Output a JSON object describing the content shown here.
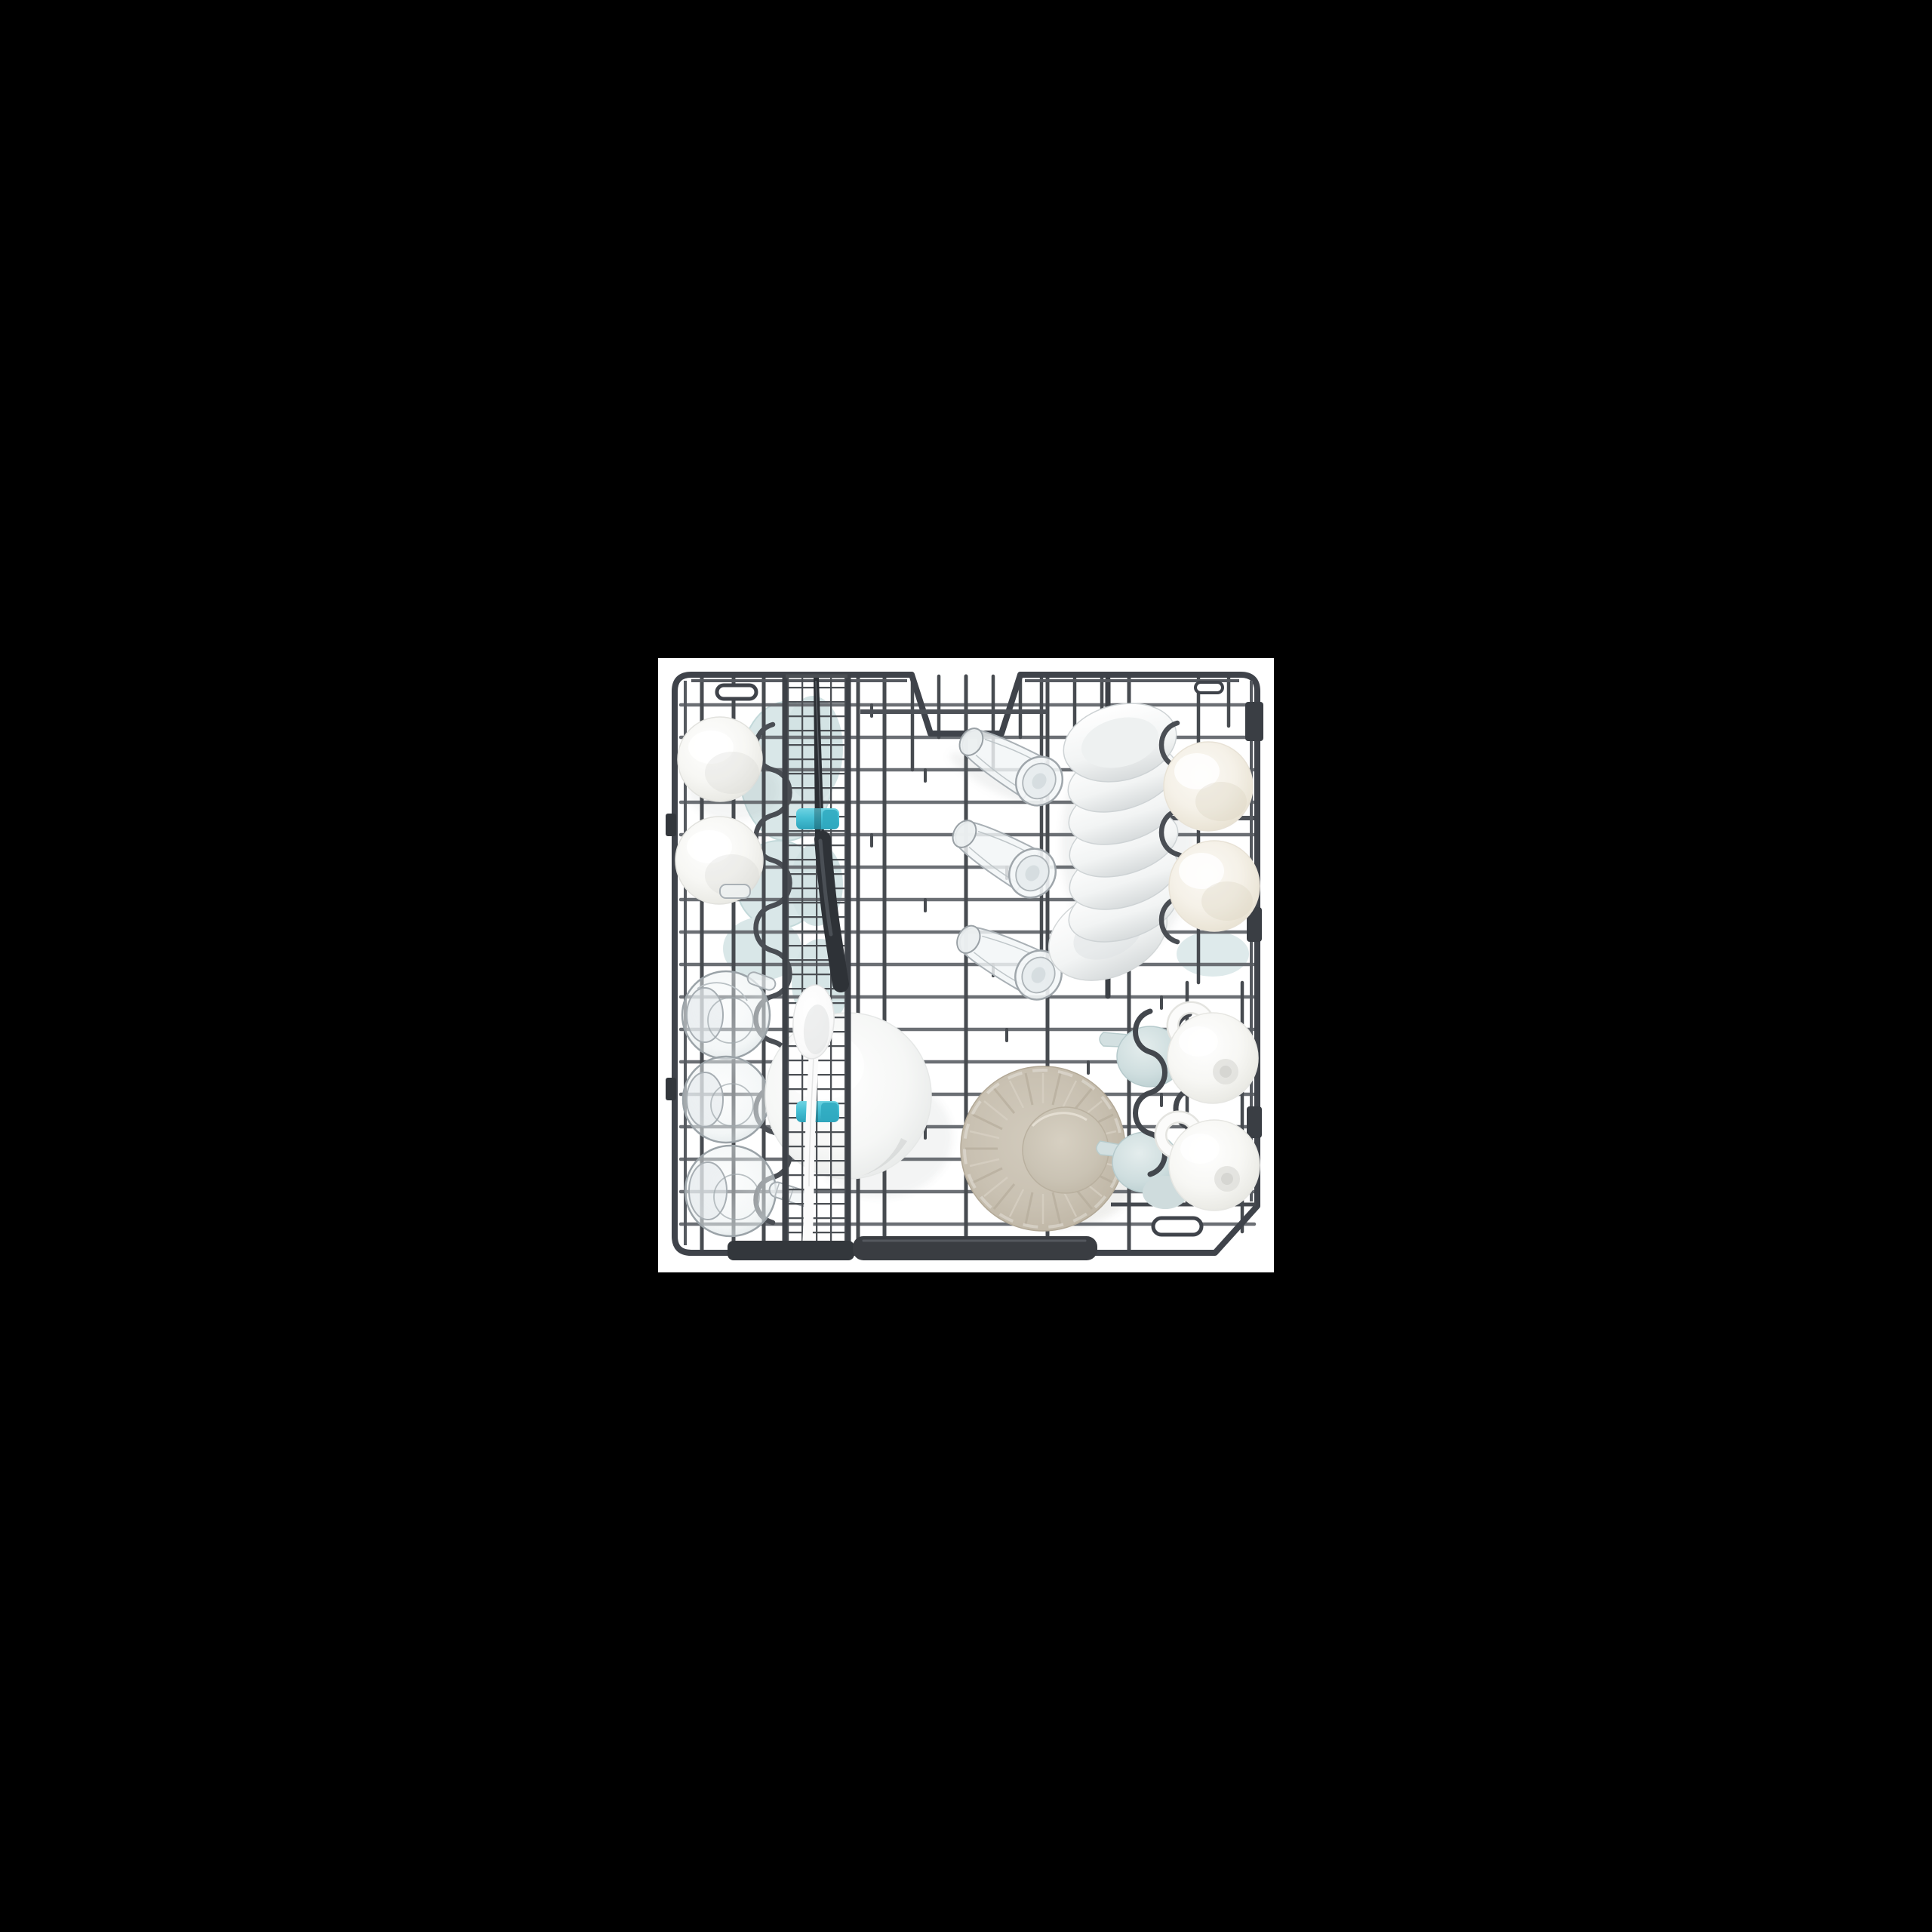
{
  "page": {
    "background": "#000000"
  },
  "photo": {
    "description": "Top-down product photograph of an open dishwasher lower rack loaded with dishes on a white background",
    "background": "#ffffff"
  },
  "colors": {
    "canvas_black": "#000000",
    "photo_white": "#ffffff",
    "rack_frame": "#3f434a",
    "rack_wire_light": "#6b6f74",
    "rack_wire_dark": "#474b50",
    "rack_bar_dark": "#34383d",
    "clip_teal": "#45bfd4",
    "dish_white": "#f8f9f8",
    "dish_cream": "#f4f0e7",
    "tinted_glass_blue": "#d9e7e8",
    "plate_beige": "#c9c1b1",
    "glass_outline": "#a0a7ac",
    "knife_black": "#2e3237"
  },
  "items": [
    {
      "id": "rack-frame",
      "label": "Dishwasher lower rack wire frame with top notch"
    },
    {
      "id": "wire-grid",
      "label": "Dark gray wire grid of the rack"
    },
    {
      "id": "cutlery-strip",
      "label": "Fine-mesh cutlery rack strip"
    },
    {
      "id": "knife",
      "label": "Black-handled knife in cutlery strip"
    },
    {
      "id": "spoon",
      "label": "White serving spoon in cutlery strip"
    },
    {
      "id": "teal-clips",
      "label": "Turquoise retaining clips"
    },
    {
      "id": "left-bowls",
      "label": "Two white bowls upside down"
    },
    {
      "id": "tinted-plates",
      "label": "Pale blue tinted glass plates"
    },
    {
      "id": "glass-jars",
      "label": "Three clear glass jars with handles"
    },
    {
      "id": "glasses",
      "label": "Three clear drinking glasses lying tilted"
    },
    {
      "id": "white-plate",
      "label": "Large white plate tucked behind cutlery strip"
    },
    {
      "id": "beige-plate",
      "label": "Beige fluted plate face down"
    },
    {
      "id": "plate-stack",
      "label": "Row of white plates standing on edge"
    },
    {
      "id": "right-bowls",
      "label": "Two cream bowls upside down"
    },
    {
      "id": "creamers",
      "label": "Two pale blue milk jugs"
    },
    {
      "id": "cups",
      "label": "Two white cups with handles upside down"
    },
    {
      "id": "handle-bar",
      "label": "Dark gray rack handle bar at bottom"
    }
  ]
}
